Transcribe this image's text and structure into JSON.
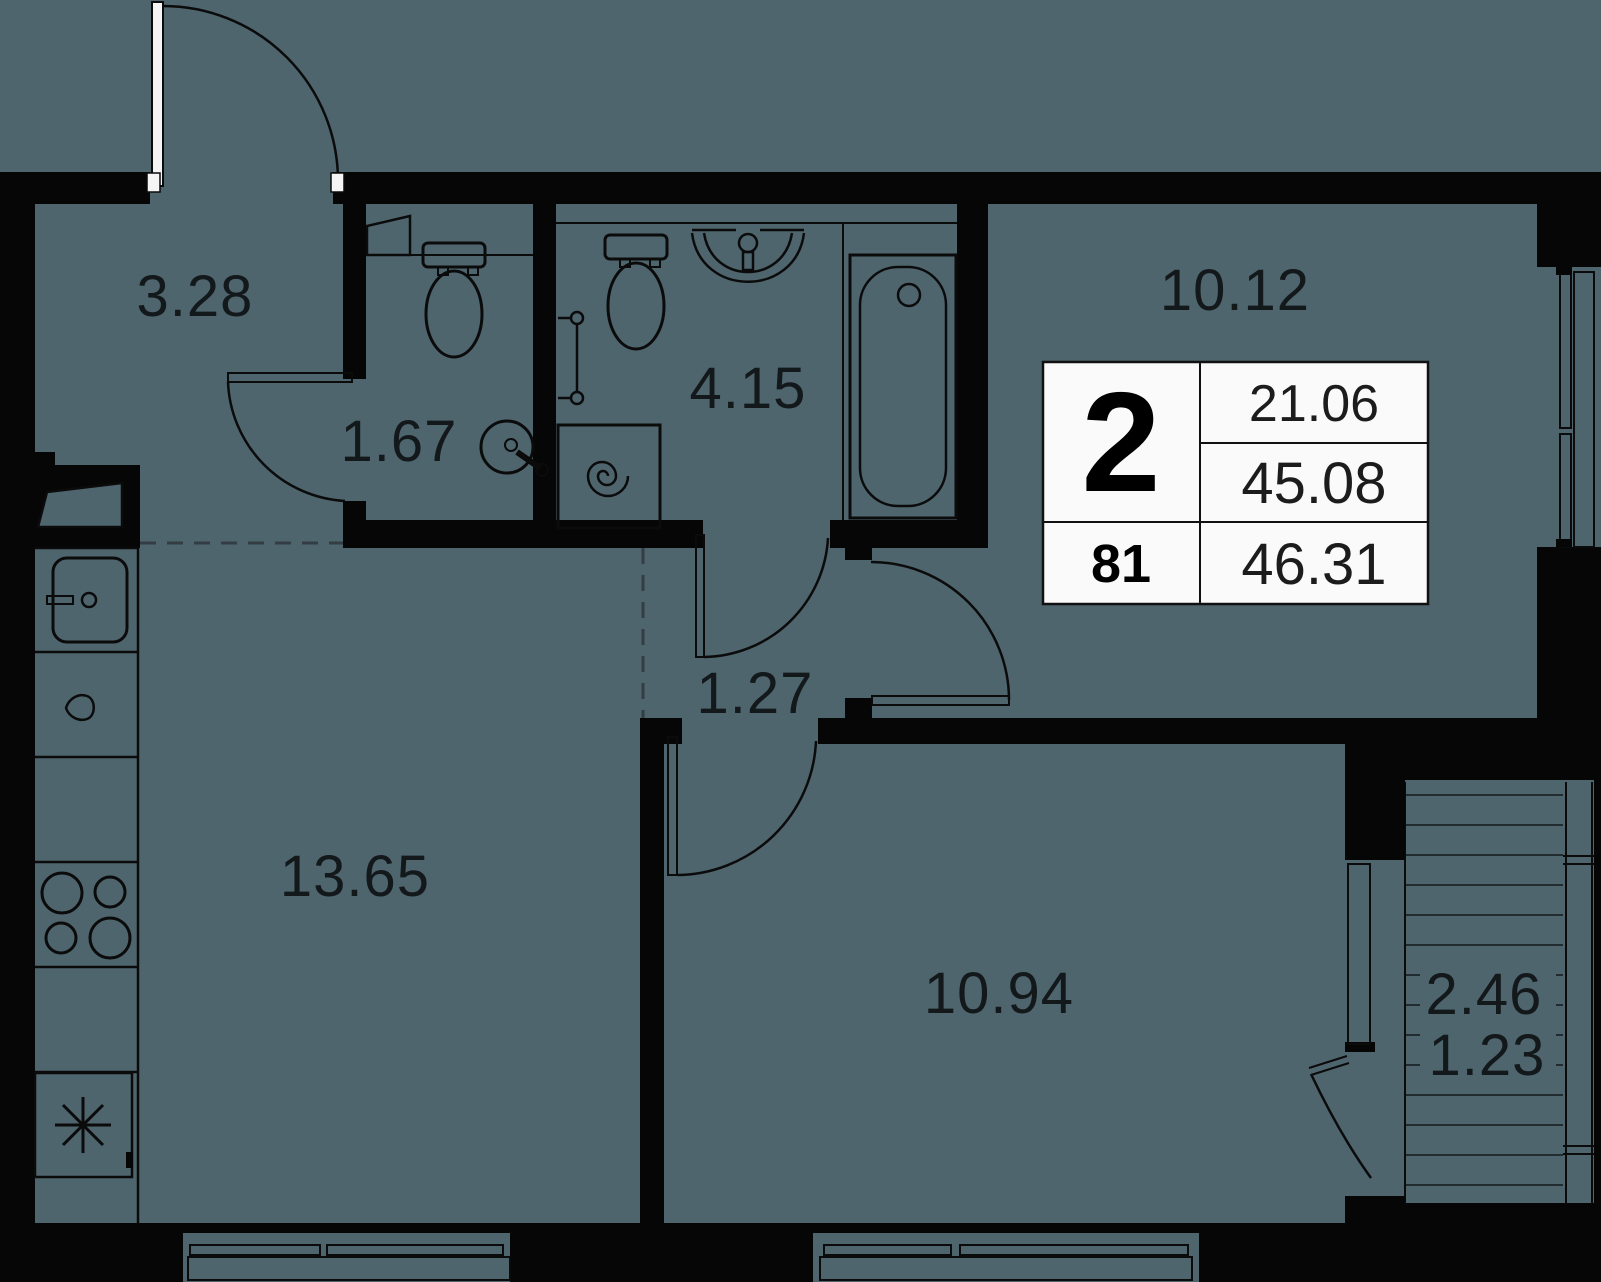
{
  "palette": {
    "background": "#4e656e",
    "wall": "#060606",
    "paper": "#fafafa",
    "ink": "#13181b",
    "dash": "#333d43"
  },
  "labels": {
    "hall": "3.28",
    "wc": "1.67",
    "bathroom": "4.15",
    "living_room": "10.12",
    "corridor": "1.27",
    "kitchen": "13.65",
    "bedroom": "10.94",
    "balcony_full": "2.46",
    "balcony_reduced": "1.23"
  },
  "info_card": {
    "room_count": "2",
    "apartment_number": "81",
    "living_area": "21.06",
    "area_without_balcony": "45.08",
    "total_area": "46.31"
  }
}
